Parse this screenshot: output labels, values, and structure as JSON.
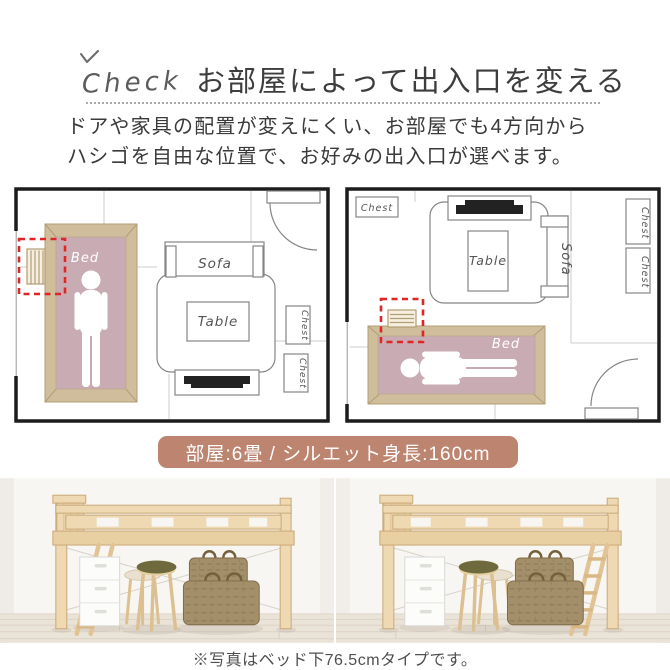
{
  "header": {
    "check_label": "Check",
    "title": "お部屋によって出入口を変える",
    "body_line1": "ドアや家具の配置が変えにくい、お部屋でも4方向から",
    "body_line2": "ハシゴを自由な位置で、お好みの出入口が選べます。"
  },
  "floor_plans": {
    "left": {
      "bed": "Bed",
      "sofa": "Sofa",
      "table": "Table",
      "chest_right_1": "Chest",
      "chest_right_2": "Chest"
    },
    "right": {
      "bed": "Bed",
      "sofa": "Sofa",
      "table": "Table",
      "chest_top_left": "Chest",
      "chest_right_1": "Chest",
      "chest_right_2": "Chest"
    }
  },
  "badge": {
    "label": "部屋:6畳 / シルエット身長:160cm",
    "bg_color": "#bd8470",
    "text_color": "#ffffff"
  },
  "photos": {
    "caption": "※写真はベッド下76.5cmタイプです。"
  },
  "icons": {
    "check_tick": "check-tick"
  },
  "colors": {
    "wall_line": "#1c1c1c",
    "furniture_line": "#858585",
    "bed_frame_tan": "#cfbd9c",
    "mattress_mauve": "#c9acb3",
    "highlight_red": "#e02525",
    "wood_pine": "#eed9b2",
    "accent_badge": "#bd8470"
  }
}
